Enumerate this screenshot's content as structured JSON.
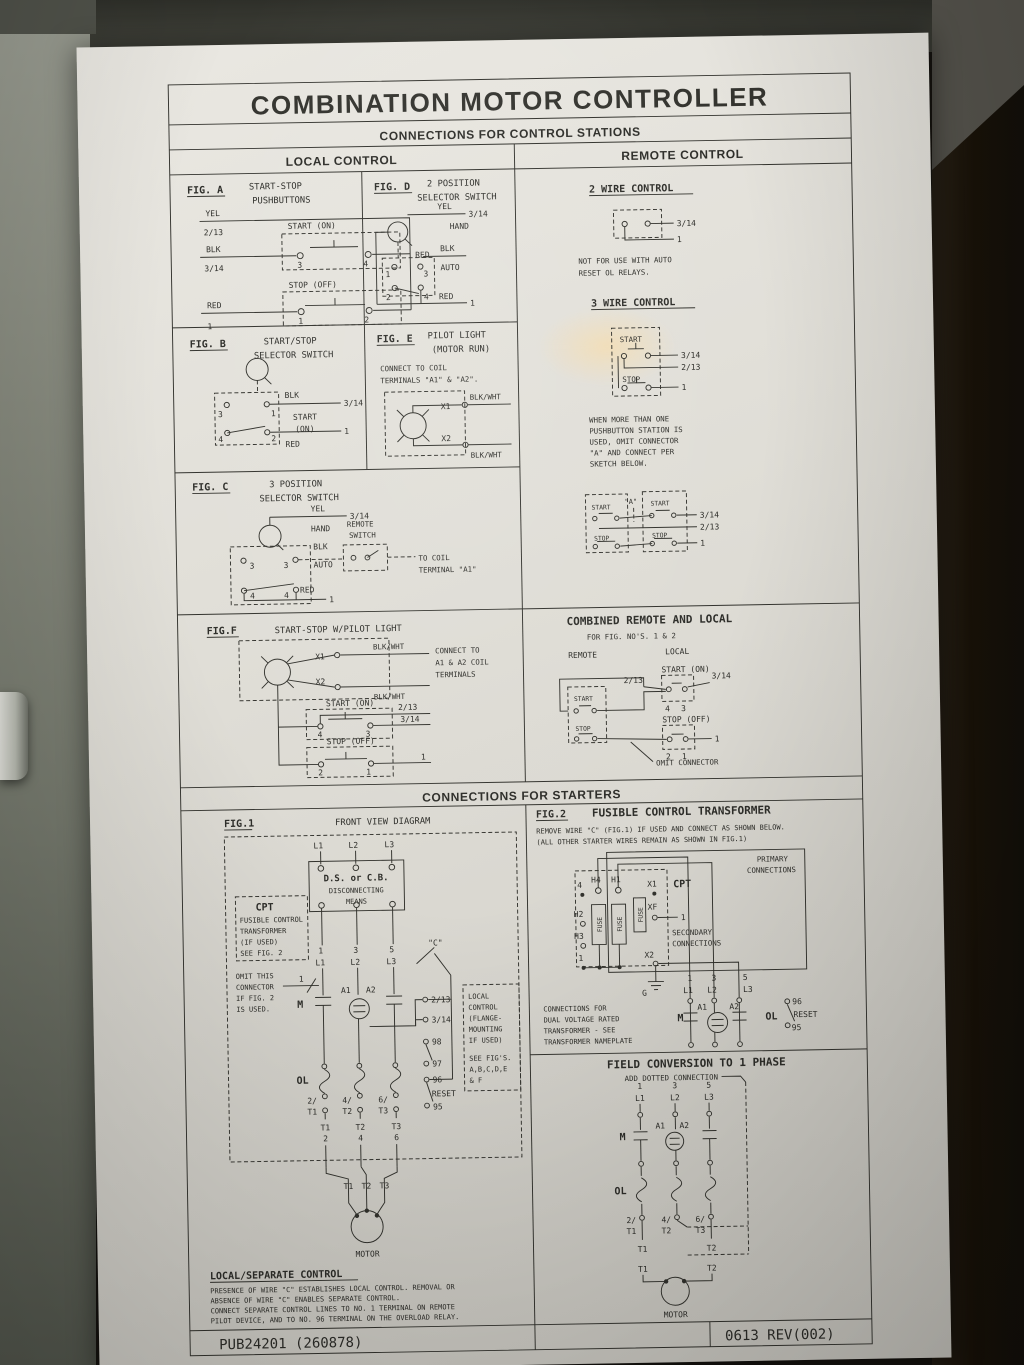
{
  "title": "COMBINATION MOTOR CONTROLLER",
  "headers": {
    "stations": "CONNECTIONS FOR CONTROL STATIONS",
    "local": "LOCAL CONTROL",
    "remote": "REMOTE CONTROL",
    "starters": "CONNECTIONS FOR STARTERS"
  },
  "figA": {
    "id": "FIG. A",
    "t1": "START-STOP",
    "t2": "PUSHBUTTONS",
    "yel": "YEL",
    "w213": "2/13",
    "blk": "BLK",
    "w314": "3/14",
    "red": "RED",
    "w1": "1",
    "start": "START (ON)",
    "stop": "STOP (OFF)",
    "red2": "RED",
    "n3": "3",
    "n4": "4",
    "n1": "1",
    "n2": "2"
  },
  "figD": {
    "id": "FIG. D",
    "t1": "2 POSITION",
    "t2": "SELECTOR SWITCH",
    "yel": "YEL",
    "w314": "3/14",
    "hand": "HAND",
    "blk": "BLK",
    "auto": "AUTO",
    "red": "RED",
    "w1": "1",
    "n1": "1",
    "n3": "3",
    "n2": "2",
    "n4": "4"
  },
  "figB": {
    "id": "FIG. B",
    "t1": "START/STOP",
    "t2": "SELECTOR SWITCH",
    "blk": "BLK",
    "w314": "3/14",
    "start": "START",
    "on": "(ON)",
    "red": "RED",
    "w1": "1",
    "n3": "3",
    "n1": "1",
    "n4": "4",
    "n2": "2"
  },
  "figE": {
    "id": "FIG. E",
    "t1": "PILOT LIGHT",
    "t2": "(MOTOR RUN)",
    "note1": "CONNECT TO COIL",
    "note2": "TERMINALS \"A1\" & \"A2\".",
    "x1": "X1",
    "x2": "X2",
    "bw": "BLK/WHT"
  },
  "figC": {
    "id": "FIG. C",
    "t1": "3 POSITION",
    "t2": "SELECTOR SWITCH",
    "yel": "YEL",
    "w314": "3/14",
    "hand": "HAND",
    "blk": "BLK",
    "auto": "AUTO",
    "rsw1": "REMOTE",
    "rsw2": "SWITCH",
    "coil1": "TO COIL",
    "coil2": "TERMINAL \"A1\"",
    "red": "RED",
    "w1": "1",
    "n3": "3",
    "n4": "4"
  },
  "figF": {
    "id": "FIG.F",
    "t": "START-STOP W/PILOT LIGHT",
    "x1": "X1",
    "x2": "X2",
    "bw": "BLK/WHT",
    "c1": "CONNECT TO",
    "c2": "A1 & A2 COIL",
    "c3": "TERMINALS",
    "start": "START (ON)",
    "w213": "2/13",
    "n4": "4",
    "n3": "3",
    "w314": "3/14",
    "stop": "STOP (OFF)",
    "n2": "2",
    "n1": "1",
    "w1": "1"
  },
  "r2w": {
    "t": "2 WIRE CONTROL",
    "w314": "3/14",
    "w1": "1",
    "note1": "NOT FOR USE WITH AUTO",
    "note2": "RESET OL RELAYS."
  },
  "r3w": {
    "t": "3 WIRE CONTROL",
    "start": "START",
    "stop": "STOP",
    "w314": "3/14",
    "w213": "2/13",
    "w1": "1",
    "a": "\"A\"",
    "note": [
      "WHEN MORE THAN ONE",
      "PUSHBUTTON STATION IS",
      "USED, OMIT CONNECTOR",
      "\"A\" AND CONNECT PER",
      "SKETCH BELOW."
    ]
  },
  "combined": {
    "t": "COMBINED REMOTE AND LOCAL",
    "sub": "FOR FIG. NO'S. 1 & 2",
    "remote": "REMOTE",
    "local": "LOCAL",
    "start": "START",
    "stop": "STOP",
    "startOn": "START (ON)",
    "stopOff": "STOP (OFF)",
    "w213": "2/13",
    "w314": "3/14",
    "w1": "1",
    "n4": "4",
    "n3": "3",
    "n2": "2",
    "n1": "1",
    "omit": "OMIT CONNECTOR"
  },
  "fig1": {
    "id": "FIG.1",
    "t": "FRONT VIEW DIAGRAM",
    "l1": "L1",
    "l2": "L2",
    "l3": "L3",
    "ds1": "D.S. or C.B.",
    "ds2": "DISCONNECTING",
    "ds3": "MEANS",
    "cpt": "CPT",
    "cptn": [
      "FUSIBLE CONTROL",
      "TRANSFORMER",
      "(IF USED)",
      "SEE FIG. 2"
    ],
    "omitn": [
      "OMIT THIS",
      "CONNECTOR",
      "IF FIG. 2",
      "IS USED."
    ],
    "n1": "1",
    "n3": "3",
    "n5": "5",
    "c": "\"C\"",
    "m": "M",
    "a1": "A1",
    "a2": "A2",
    "w213": "2/13",
    "w314": "3/14",
    "n98": "98",
    "n97": "97",
    "n96": "96",
    "reset": "RESET",
    "n95": "95",
    "ol": "OL",
    "t2a": "2/",
    "t2b": "T1",
    "t4a": "4/",
    "t4b": "T2",
    "t6a": "6/",
    "t6b": "T3",
    "bt1": "T1",
    "b2": "2",
    "bt2": "T2",
    "b4": "4",
    "bt3": "T3",
    "b6": "6",
    "lc": [
      "LOCAL",
      "CONTROL",
      "(FLANGE-",
      "MOUNTING",
      "IF USED)",
      "SEE FIG'S.",
      "A,B,C,D,E",
      "& F"
    ],
    "mt1": "T1",
    "mt2": "T2",
    "mt3": "T3",
    "motor": "MOTOR"
  },
  "lsc": {
    "t": "LOCAL/SEPARATE CONTROL",
    "l": [
      "PRESENCE OF WIRE \"C\" ESTABLISHES LOCAL CONTROL. REMOVAL OR",
      "ABSENCE OF WIRE \"C\" ENABLES SEPARATE CONTROL.",
      "CONNECT SEPARATE CONTROL LINES TO NO. 1 TERMINAL ON REMOTE",
      "PILOT DEVICE, AND TO NO. 96 TERMINAL ON THE OVERLOAD RELAY."
    ]
  },
  "fig2": {
    "id": "FIG.2",
    "t": "FUSIBLE CONTROL TRANSFORMER",
    "note1": "REMOVE WIRE \"C\" (FIG.1) IF USED AND CONNECT AS SHOWN BELOW.",
    "note2": "(ALL OTHER STARTER WIRES REMAIN AS SHOWN IN FIG.1)",
    "pri1": "PRIMARY",
    "pri2": "CONNECTIONS",
    "h4": "H4",
    "h1": "H1",
    "x1": "X1",
    "cpt": "CPT",
    "n4": "4",
    "h2": "H2",
    "h3": "H3",
    "one": "1",
    "fuse": "FUSE",
    "xf": "XF",
    "sec1": "SECONDARY",
    "sec2": "CONNECTIONS",
    "x2": "X2",
    "g": "G",
    "dual": [
      "CONNECTIONS FOR",
      "DUAL VOLTAGE RATED",
      "TRANSFORMER - SEE",
      "TRANSFORMER NAMEPLATE"
    ],
    "b1": "1",
    "b3": "3",
    "b5": "5",
    "l1": "L1",
    "l2": "L2",
    "l3": "L3",
    "m": "M",
    "a1": "A1",
    "a2": "A2",
    "ol": "OL",
    "n96": "96",
    "reset": "RESET",
    "n95": "95"
  },
  "fc": {
    "t": "FIELD CONVERSION TO 1 PHASE",
    "sub": "ADD DOTTED CONNECTION",
    "n1": "1",
    "n3": "3",
    "n5": "5",
    "l1": "L1",
    "l2": "L2",
    "l3": "L3",
    "m": "M",
    "a1": "A1",
    "a2": "A2",
    "ol": "OL",
    "t2a": "2/",
    "t2b": "T1",
    "t4a": "4/",
    "t4b": "T2",
    "t6a": "6/",
    "t6b": "T3",
    "bt1": "T1",
    "bt2": "T2",
    "mt1": "T1",
    "mt2": "T2",
    "motor": "MOTOR"
  },
  "footer": {
    "pub": "PUB24201 (260878)",
    "rev": "0613 REV(002)"
  }
}
